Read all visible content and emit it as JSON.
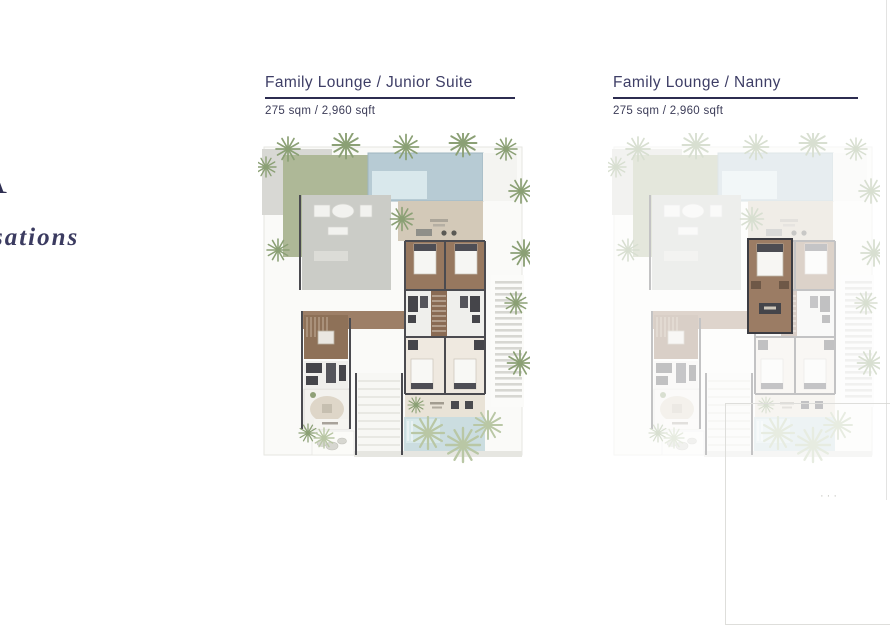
{
  "brand": {
    "partial_letter": "A",
    "partial_word": "sations"
  },
  "plans": [
    {
      "title": "Family Lounge / Junior Suite",
      "area": "275 sqm / 2,960 sqft",
      "variant": "full-color"
    },
    {
      "title": "Family Lounge / Nanny",
      "area": "275 sqm / 2,960 sqft",
      "variant": "faded-with-nanny-room-highlight"
    }
  ],
  "footer": {
    "marks": "···"
  },
  "colors": {
    "title_text": "#3e3e66",
    "rule": "#2c2c50",
    "brand_text": "#2f2f52",
    "pool": "#b7cbd4",
    "pool_light": "#d9e8ec",
    "garden_green": "#aeb897",
    "palm_green": "#8ba075",
    "palm_light": "#b9c7a5",
    "floor_brown": "#97785f",
    "corridor_brown": "#9d7f67",
    "stair_brown": "#8a6b54",
    "patio_gray": "#cbccc7",
    "terrace_tan": "#d3c9b8",
    "wall_dark": "#4b4b50",
    "fixture_dark": "#45454a",
    "water_light": "#cbdde0",
    "nanny_room": "#9b7c64"
  }
}
